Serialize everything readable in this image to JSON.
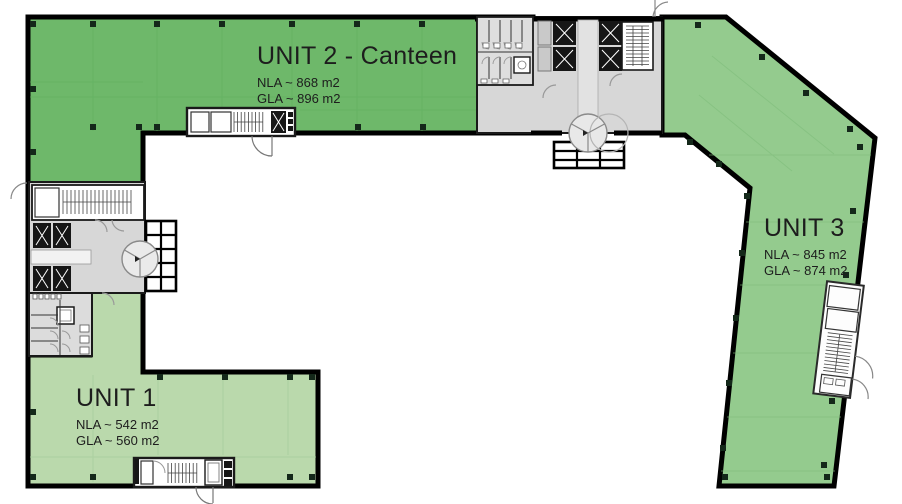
{
  "units": {
    "unit2": {
      "name": "UNIT 2 - Canteen",
      "nla": "NLA ~ 868 m2",
      "gla": "GLA ~ 896 m2",
      "fill": "#6eb86a"
    },
    "unit3": {
      "name": "UNIT 3",
      "nla": "NLA ~ 845 m2",
      "gla": "GLA ~ 874 m2",
      "fill": "#94cb8e"
    },
    "unit1": {
      "name": "UNIT 1",
      "nla": "NLA ~ 542 m2",
      "gla": "GLA ~ 560 m2",
      "fill": "#bad9ac"
    }
  },
  "palette": {
    "wall": "#000000",
    "core_fill": "#d7d7d7",
    "column": "#14281a",
    "label_text": "#1d1d1d"
  }
}
